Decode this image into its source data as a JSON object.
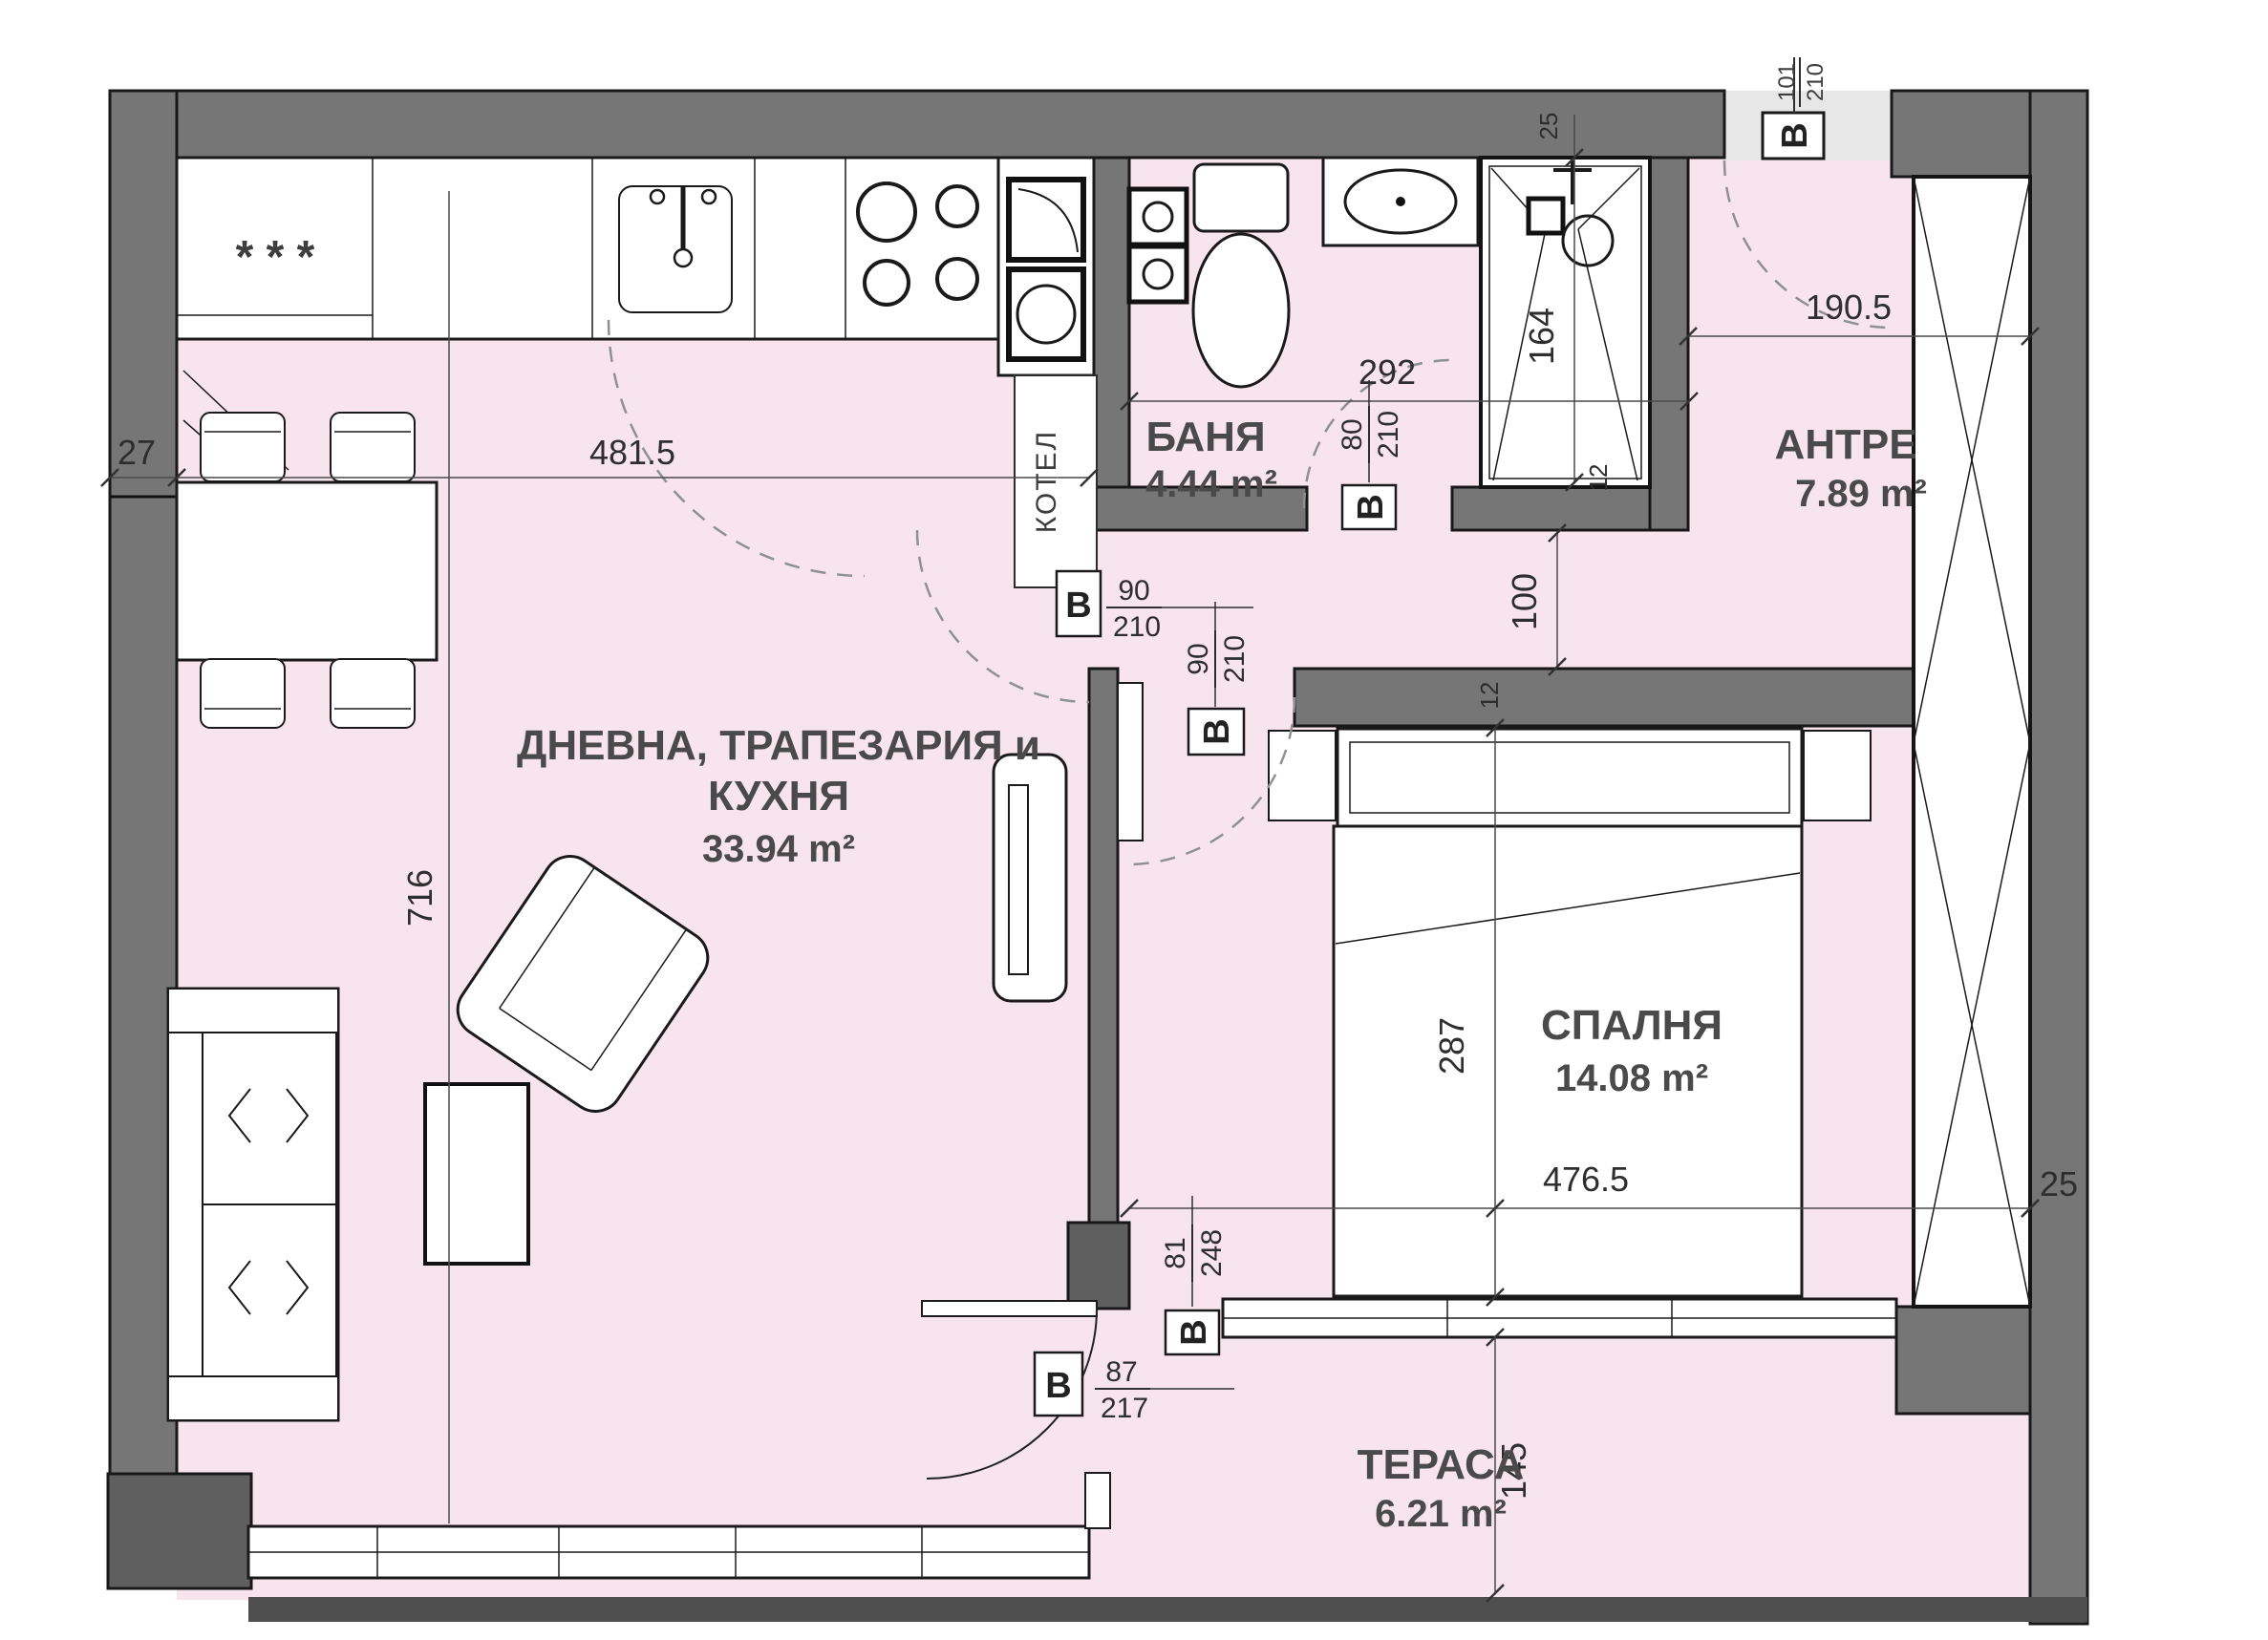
{
  "plan": {
    "rooms": {
      "living": {
        "line1": "ДНЕВНА, ТРАПЕЗАРИЯ и",
        "line2": "КУХНЯ",
        "area": "33.94 m²"
      },
      "bath": {
        "name": "БАНЯ",
        "area": "4.44 m²"
      },
      "antre": {
        "name": "АНТРЕ",
        "area": "7.89 m²"
      },
      "bedroom": {
        "name": "СПАЛНЯ",
        "area": "14.08 m²"
      },
      "terrace": {
        "name": "ТЕРАСА",
        "area": "6.21 m²"
      }
    },
    "fixtures": {
      "boiler": "КОТЕЛ",
      "fridge_marks": "* * *"
    },
    "doors": {
      "entry": {
        "tag": "B",
        "num": "101",
        "den": "210"
      },
      "bath": {
        "tag": "B",
        "num": "80",
        "den": "210"
      },
      "hall": {
        "tag": "B",
        "num": "90",
        "den": "210"
      },
      "bedroom": {
        "tag": "B",
        "num": "90",
        "den": "210"
      },
      "terrace": {
        "tag": "B",
        "num": "87",
        "den": "217"
      },
      "balcony": {
        "tag": "B",
        "num": "81",
        "den": "248"
      }
    },
    "dimensions": {
      "d481": "481.5",
      "d27": "27",
      "d716": "716",
      "d292": "292",
      "d25_shower": "25",
      "d164": "164",
      "d190": "190.5",
      "d100": "100",
      "d12_bed": "12",
      "d12_shower": "12",
      "d287": "287",
      "d476": "476.5",
      "d145": "145",
      "d25_right": "25"
    },
    "colors": {
      "floor": "#f8e4ec",
      "wall": "#767676",
      "entry_floor": "#e7e7e7",
      "slab": "#4f4f4f"
    }
  }
}
